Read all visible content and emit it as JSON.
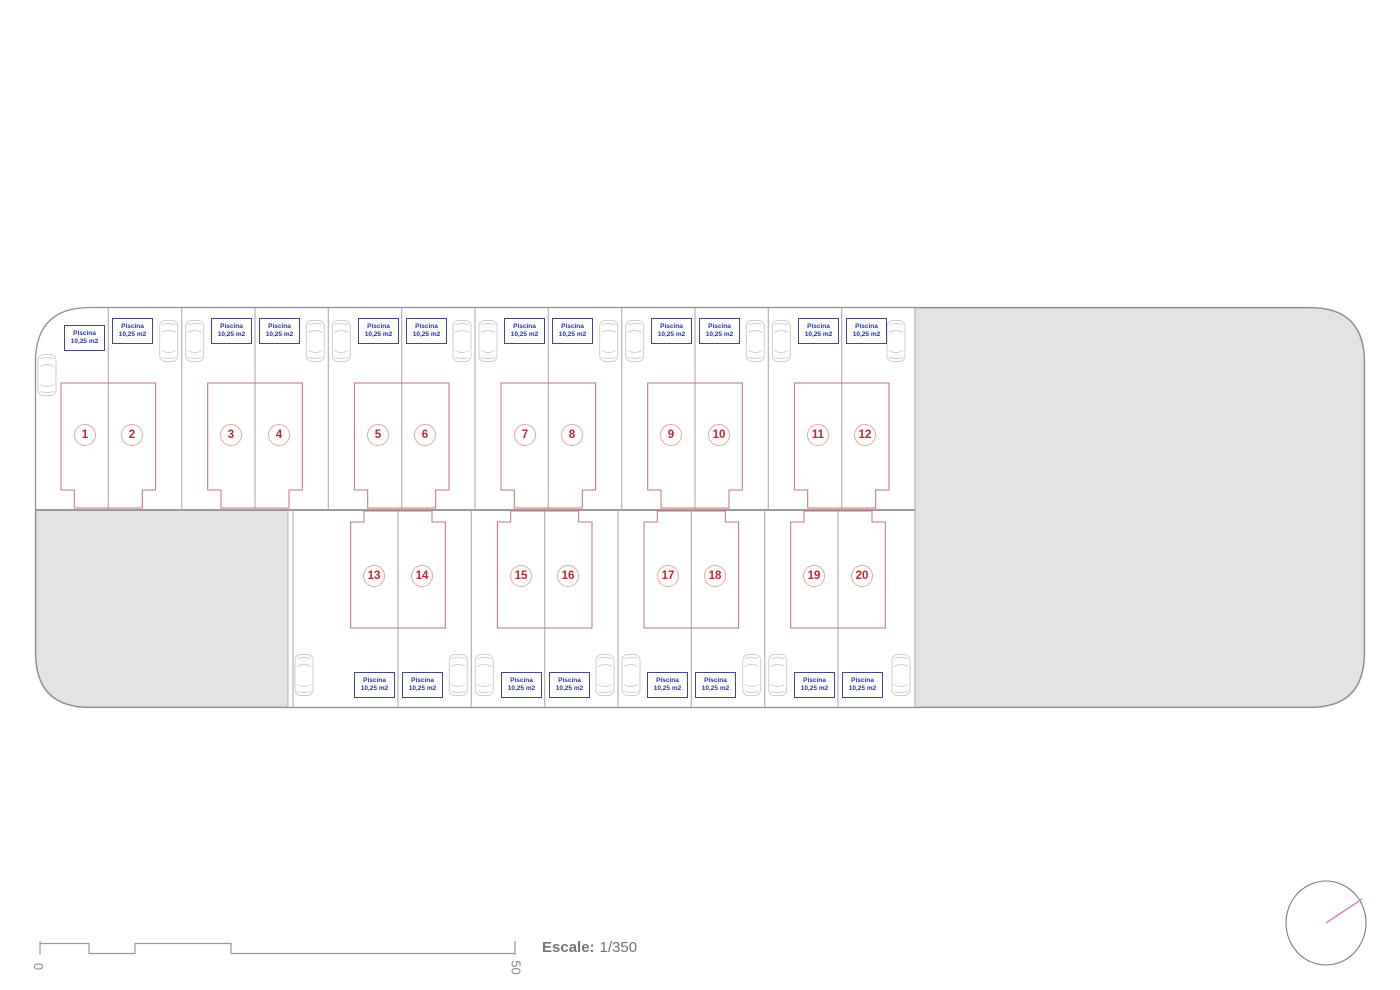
{
  "plots": [
    {
      "number": "1",
      "pool_line1": "Piscina",
      "pool_line2": "10,25 m2"
    },
    {
      "number": "2",
      "pool_line1": "Piscina",
      "pool_line2": "10,25 m2"
    },
    {
      "number": "3",
      "pool_line1": "Piscina",
      "pool_line2": "10,25 m2"
    },
    {
      "number": "4",
      "pool_line1": "Piscina",
      "pool_line2": "10,25 m2"
    },
    {
      "number": "5",
      "pool_line1": "Piscina",
      "pool_line2": "10,25 m2"
    },
    {
      "number": "6",
      "pool_line1": "Piscina",
      "pool_line2": "10,25 m2"
    },
    {
      "number": "7",
      "pool_line1": "Piscina",
      "pool_line2": "10,25 m2"
    },
    {
      "number": "8",
      "pool_line1": "Piscina",
      "pool_line2": "10,25 m2"
    },
    {
      "number": "9",
      "pool_line1": "Piscina",
      "pool_line2": "10,25 m2"
    },
    {
      "number": "10",
      "pool_line1": "Piscina",
      "pool_line2": "10,25 m2"
    },
    {
      "number": "11",
      "pool_line1": "Piscina",
      "pool_line2": "10,25 m2"
    },
    {
      "number": "12",
      "pool_line1": "Piscina",
      "pool_line2": "10,25 m2"
    },
    {
      "number": "13",
      "pool_line1": "Piscina",
      "pool_line2": "10,25 m2"
    },
    {
      "number": "14",
      "pool_line1": "Piscina",
      "pool_line2": "10,25 m2"
    },
    {
      "number": "15",
      "pool_line1": "Piscina",
      "pool_line2": "10,25 m2"
    },
    {
      "number": "16",
      "pool_line1": "Piscina",
      "pool_line2": "10,25 m2"
    },
    {
      "number": "17",
      "pool_line1": "Piscina",
      "pool_line2": "10,25 m2"
    },
    {
      "number": "18",
      "pool_line1": "Piscina",
      "pool_line2": "10,25 m2"
    },
    {
      "number": "19",
      "pool_line1": "Piscina",
      "pool_line2": "10,25 m2"
    },
    {
      "number": "20",
      "pool_line1": "Piscina",
      "pool_line2": "10,25 m2"
    }
  ],
  "scale_bar": {
    "start": "0",
    "end": "50",
    "caption_bold": "Escale:",
    "caption_value": "1/350"
  },
  "colors": {
    "common_area_fill": "#e3e3e3",
    "boundary_line": "#8f8f8f",
    "plot_divider": "#b3b3b3",
    "building_outline": "#c87070",
    "plot_number_red": "#c0272d",
    "pool_box_border": "#44448c",
    "pool_text_blue": "#2233aa",
    "car_outline": "#cfcfcf",
    "compass_needle_pink": "#cc88cc"
  }
}
